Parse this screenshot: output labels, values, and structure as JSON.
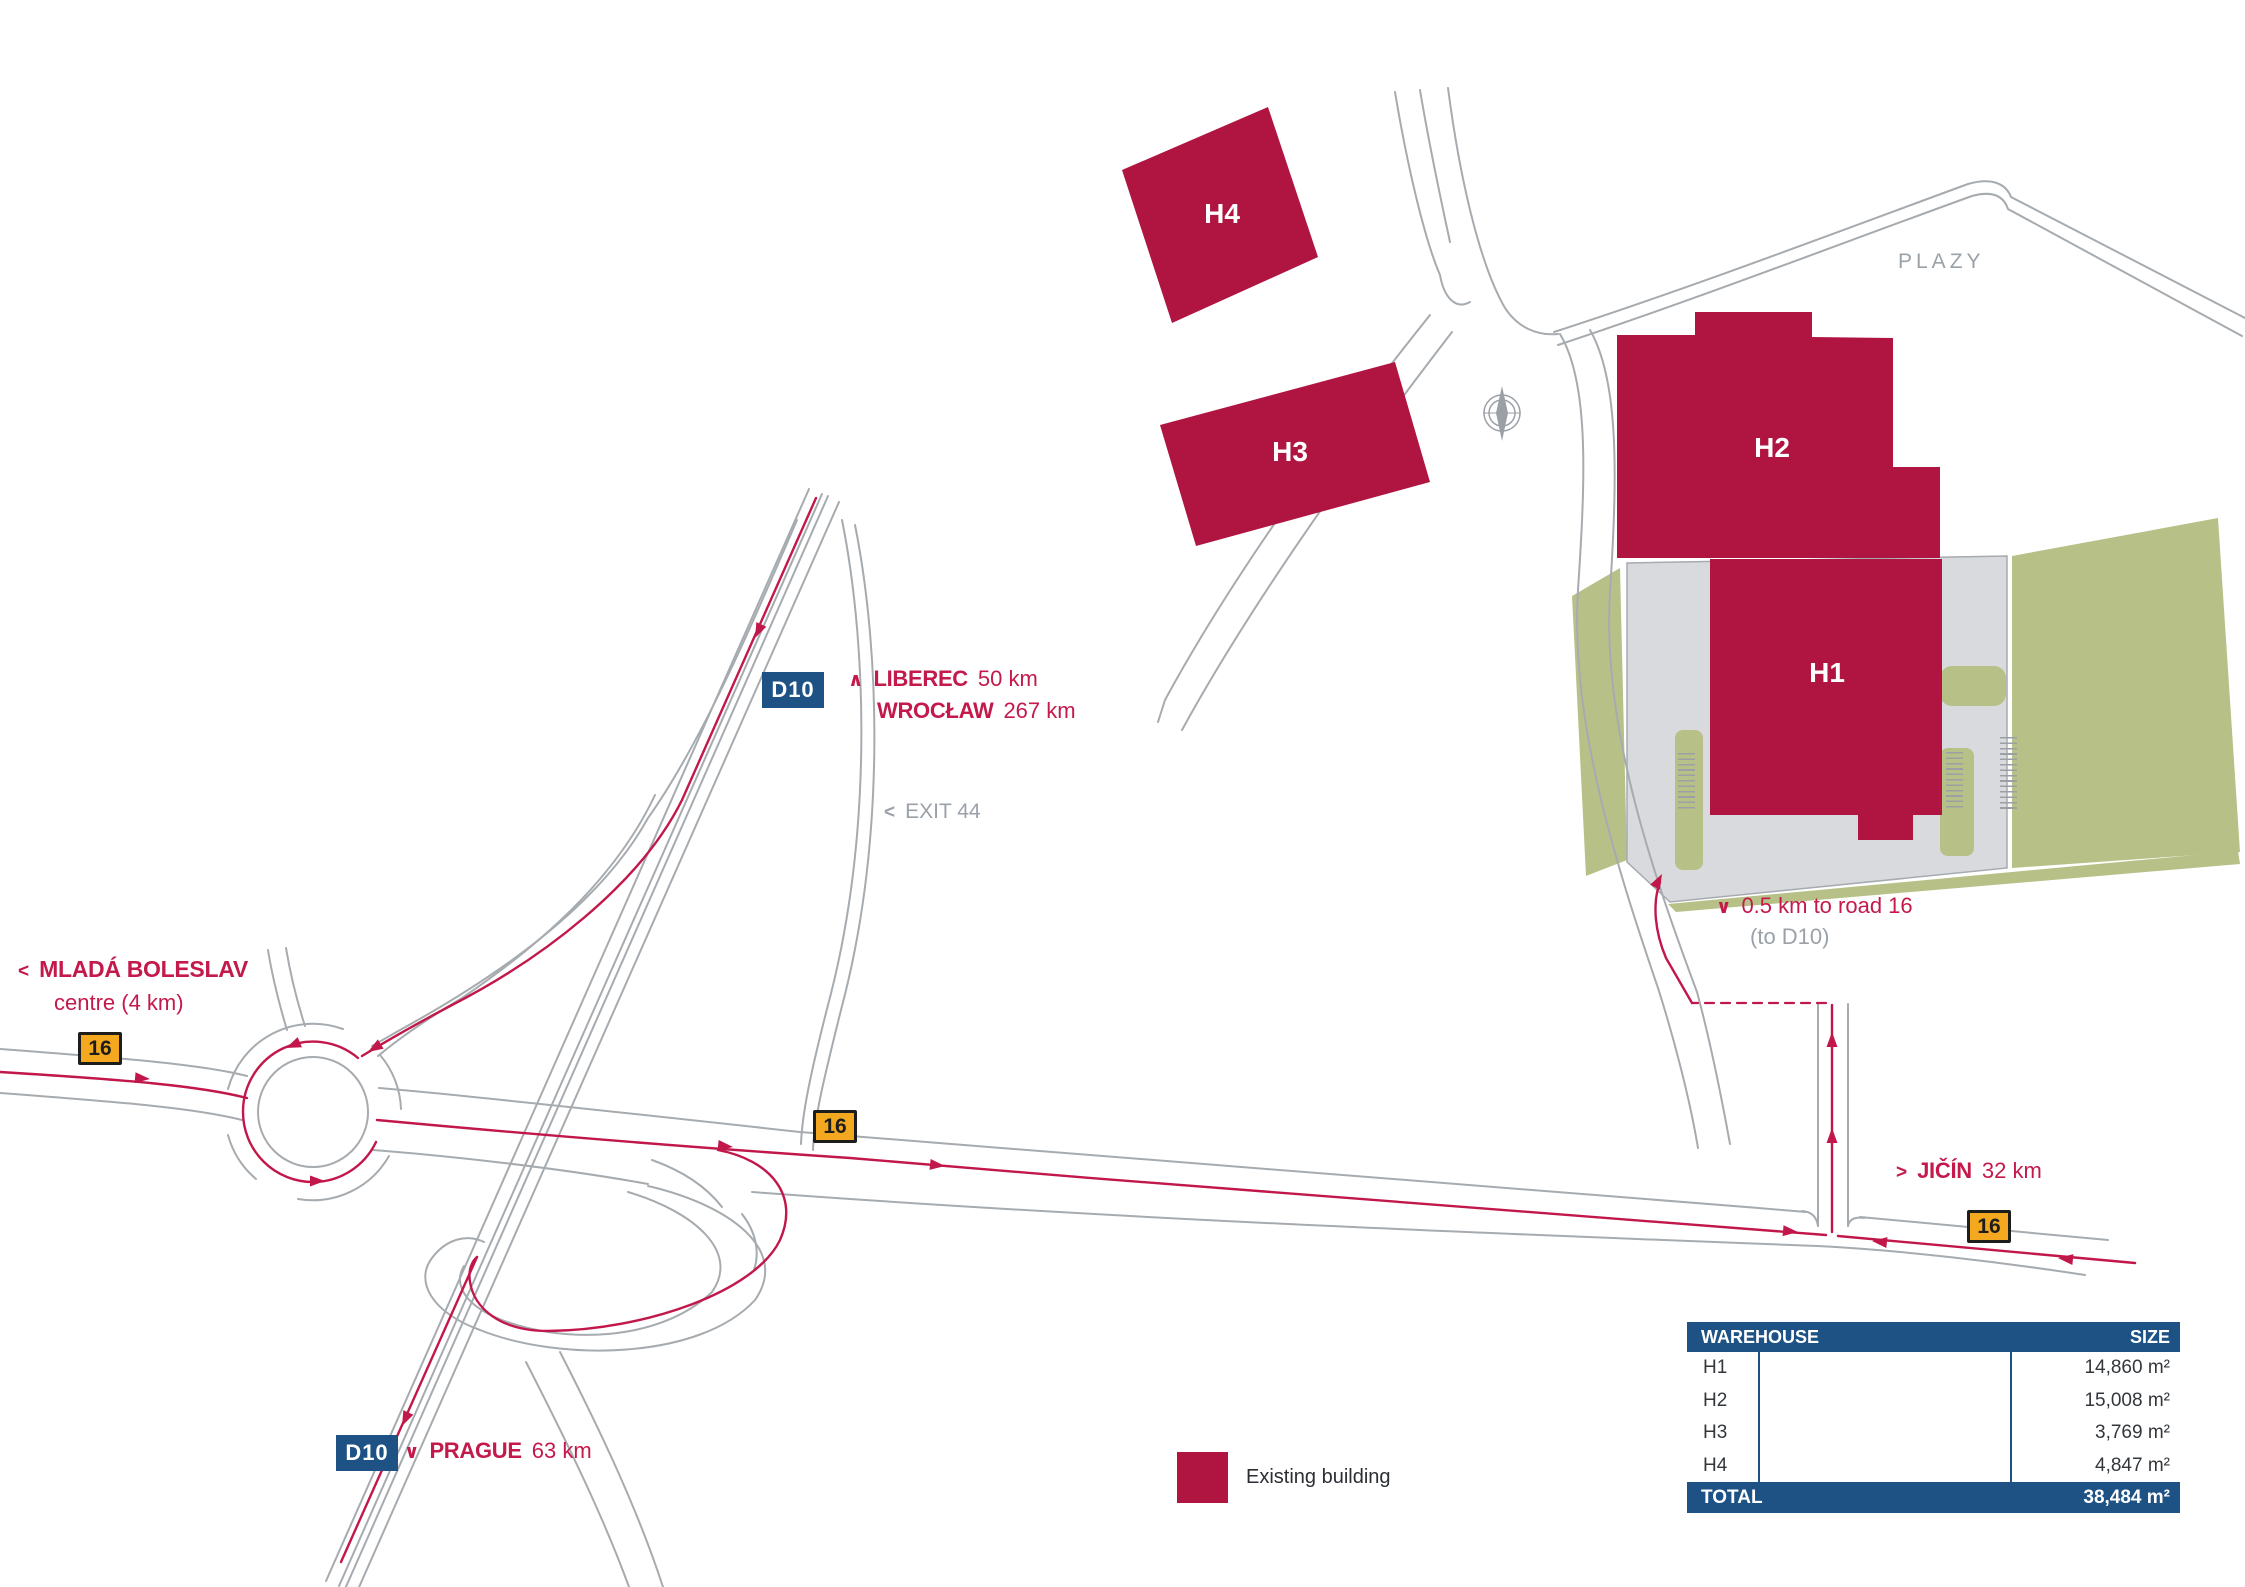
{
  "colors": {
    "building": "#b01441",
    "route_red": "#c2174a",
    "road_gray": "#a6abb0",
    "green": "#b7c187",
    "pavement": "#d8dade",
    "table_blue": "#1e5285",
    "badge_orange": "#f3a81f"
  },
  "map": {
    "area_label": "PLAZY",
    "exit": {
      "chevron": "<",
      "label": "EXIT 44"
    },
    "routes": {
      "liberec": {
        "chevron": "∧",
        "name": "LIBEREC",
        "distance": "50 km"
      },
      "wroclaw": {
        "name": "WROCŁAW",
        "distance": "267 km"
      },
      "mlada_boleslav": {
        "chevron": "<",
        "name": "MLADÁ BOLESLAV",
        "note": "centre (4 km)"
      },
      "prague": {
        "chevron": "∨",
        "name": "PRAGUE",
        "distance": "63 km"
      },
      "jicin": {
        "chevron": ">",
        "name": "JIČÍN",
        "distance": "32 km"
      },
      "site_access": {
        "chevron": "∨",
        "label": "0.5 km to road 16",
        "note": "(to D10)"
      }
    },
    "badges": {
      "motorway": "D10",
      "road": "16"
    },
    "buildings": [
      {
        "label": "H1"
      },
      {
        "label": "H2"
      },
      {
        "label": "H3"
      },
      {
        "label": "H4"
      }
    ]
  },
  "table": {
    "columns": [
      "WAREHOUSE",
      "SIZE"
    ],
    "rows": [
      {
        "name": "H1",
        "size": "14,860 m²"
      },
      {
        "name": "H2",
        "size": "15,008 m²"
      },
      {
        "name": "H3",
        "size": "3,769 m²"
      },
      {
        "name": "H4",
        "size": "4,847 m²"
      }
    ],
    "total": {
      "name": "TOTAL",
      "size": "38,484 m²"
    }
  },
  "legend": {
    "existing": "Existing building"
  }
}
